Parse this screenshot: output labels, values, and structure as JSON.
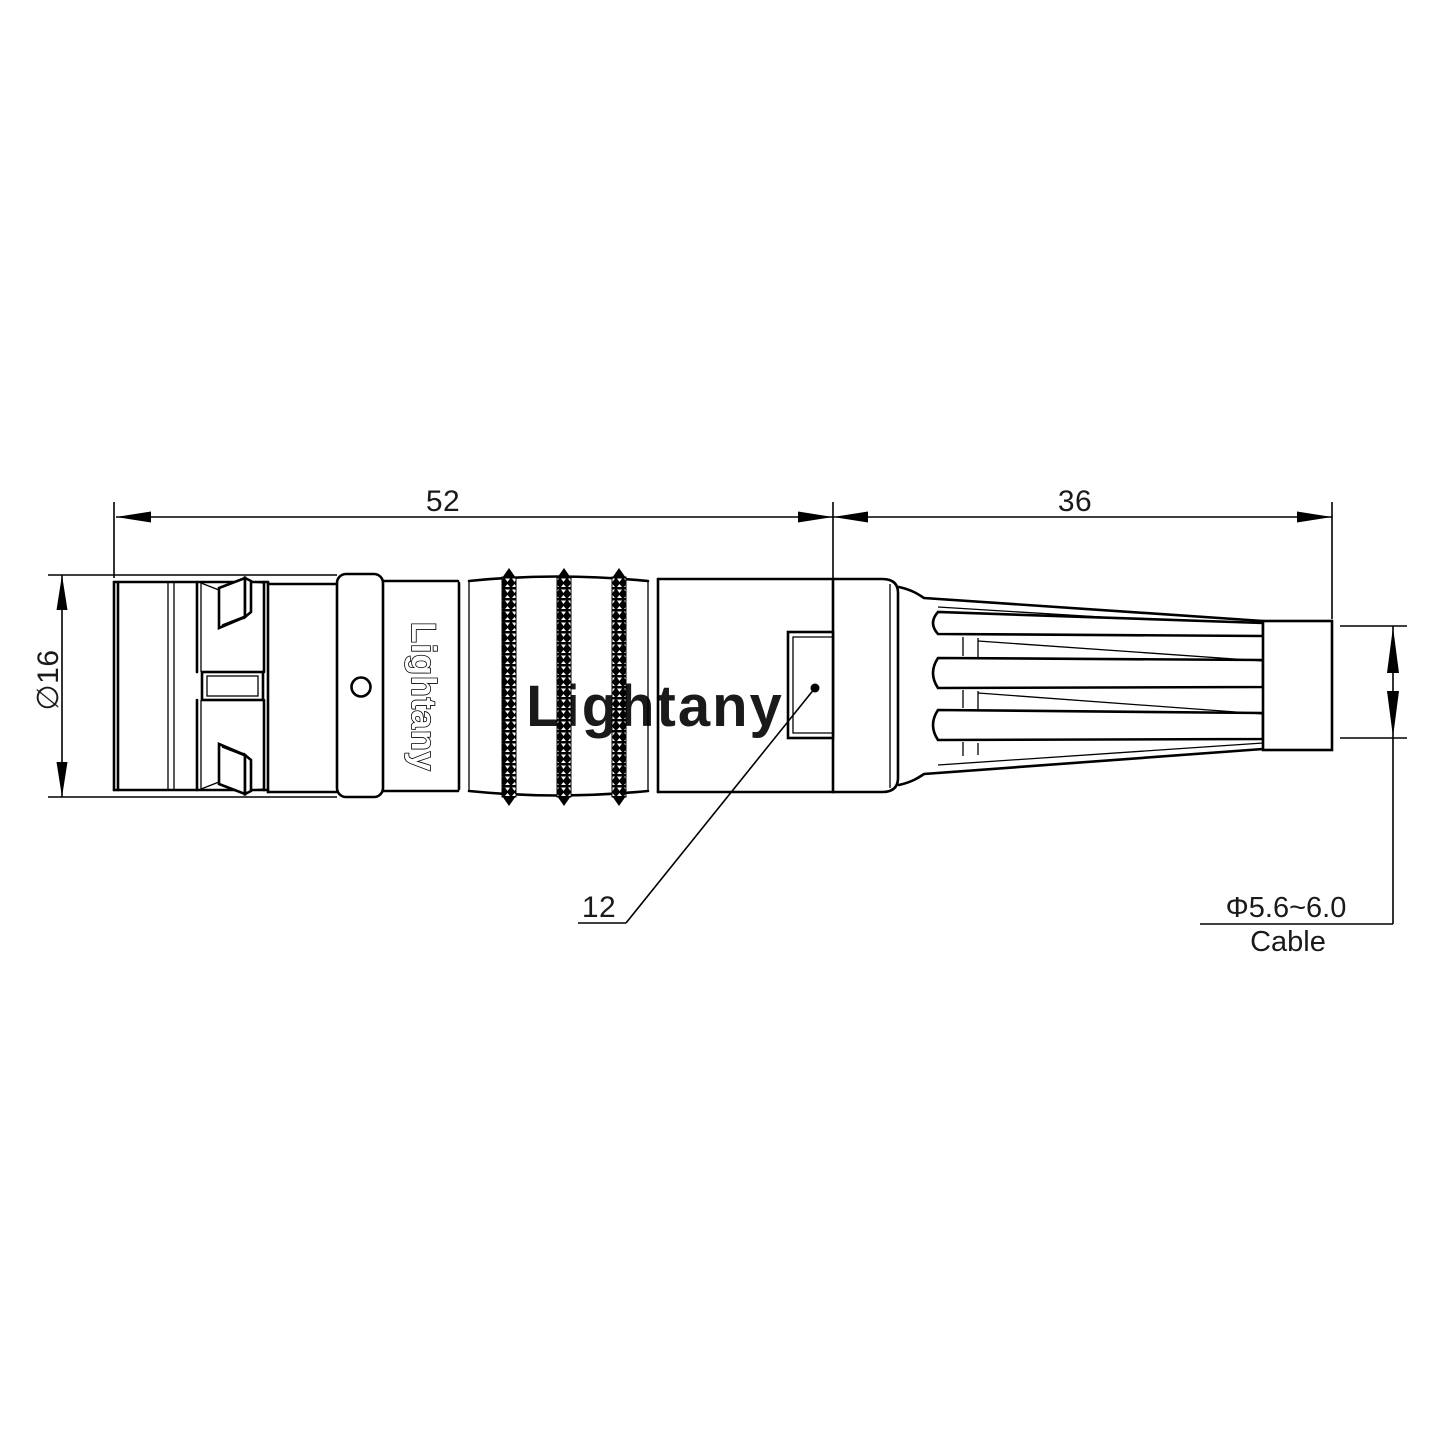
{
  "drawing": {
    "background": "#ffffff",
    "line_color": "#000000",
    "watermark_color": "#f2c4c4",
    "dimensions": {
      "front_length": "52",
      "rear_length": "36",
      "body_diameter": "∅16",
      "window_label": "12",
      "cable_diameter": "Φ5.6~6.0",
      "cable_caption": "Cable"
    },
    "branding": {
      "engraving": "Lightany",
      "watermark": "Lightany"
    }
  }
}
